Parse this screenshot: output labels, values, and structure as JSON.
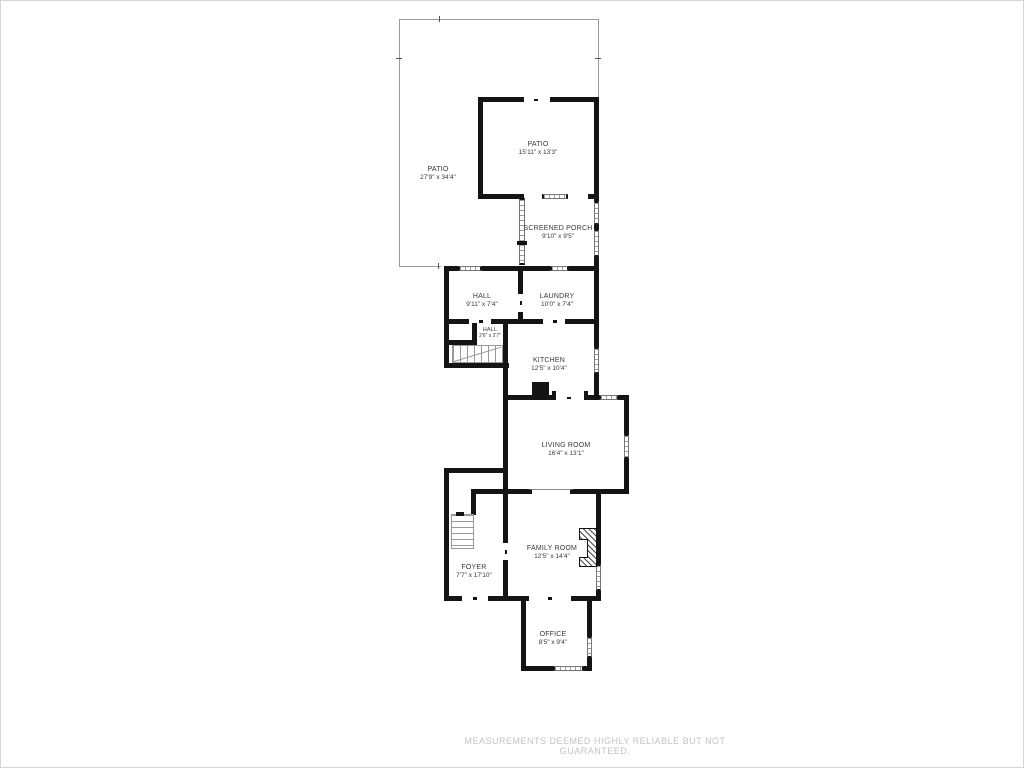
{
  "page": {
    "footer": "MEASUREMENTS DEEMED HIGHLY RELIABLE BUT NOT GUARANTEED."
  },
  "colors": {
    "wall": "#141414",
    "window_stripe": "#9a9a9a",
    "label_text": "#383838",
    "footer_text": "#c3c3c3",
    "patio_outline": "#9a9a9a"
  },
  "rooms": [
    {
      "id": "patio-large",
      "name": "PATIO",
      "dims": "27'9\" x 34'4\""
    },
    {
      "id": "patio",
      "name": "PATIO",
      "dims": "15'11\" x 13'3\""
    },
    {
      "id": "screened-porch",
      "name": "SCREENED PORCH",
      "dims": "9'10\" x 9'5\""
    },
    {
      "id": "hall",
      "name": "HALL",
      "dims": "9'11\" x 7'4\""
    },
    {
      "id": "laundry",
      "name": "LAUNDRY",
      "dims": "10'0\" x 7'4\""
    },
    {
      "id": "hall-small",
      "name": "HALL",
      "dims": "2'6\" x 2'7\""
    },
    {
      "id": "kitchen",
      "name": "KITCHEN",
      "dims": "12'5\" x 10'4\""
    },
    {
      "id": "living-room",
      "name": "LIVING ROOM",
      "dims": "16'4\" x 13'1\""
    },
    {
      "id": "family-room",
      "name": "FAMILY ROOM",
      "dims": "12'5\" x 14'4\""
    },
    {
      "id": "foyer",
      "name": "FOYER",
      "dims": "7'7\" x 17'10\""
    },
    {
      "id": "office",
      "name": "OFFICE",
      "dims": "8'5\" x 9'4\""
    }
  ]
}
